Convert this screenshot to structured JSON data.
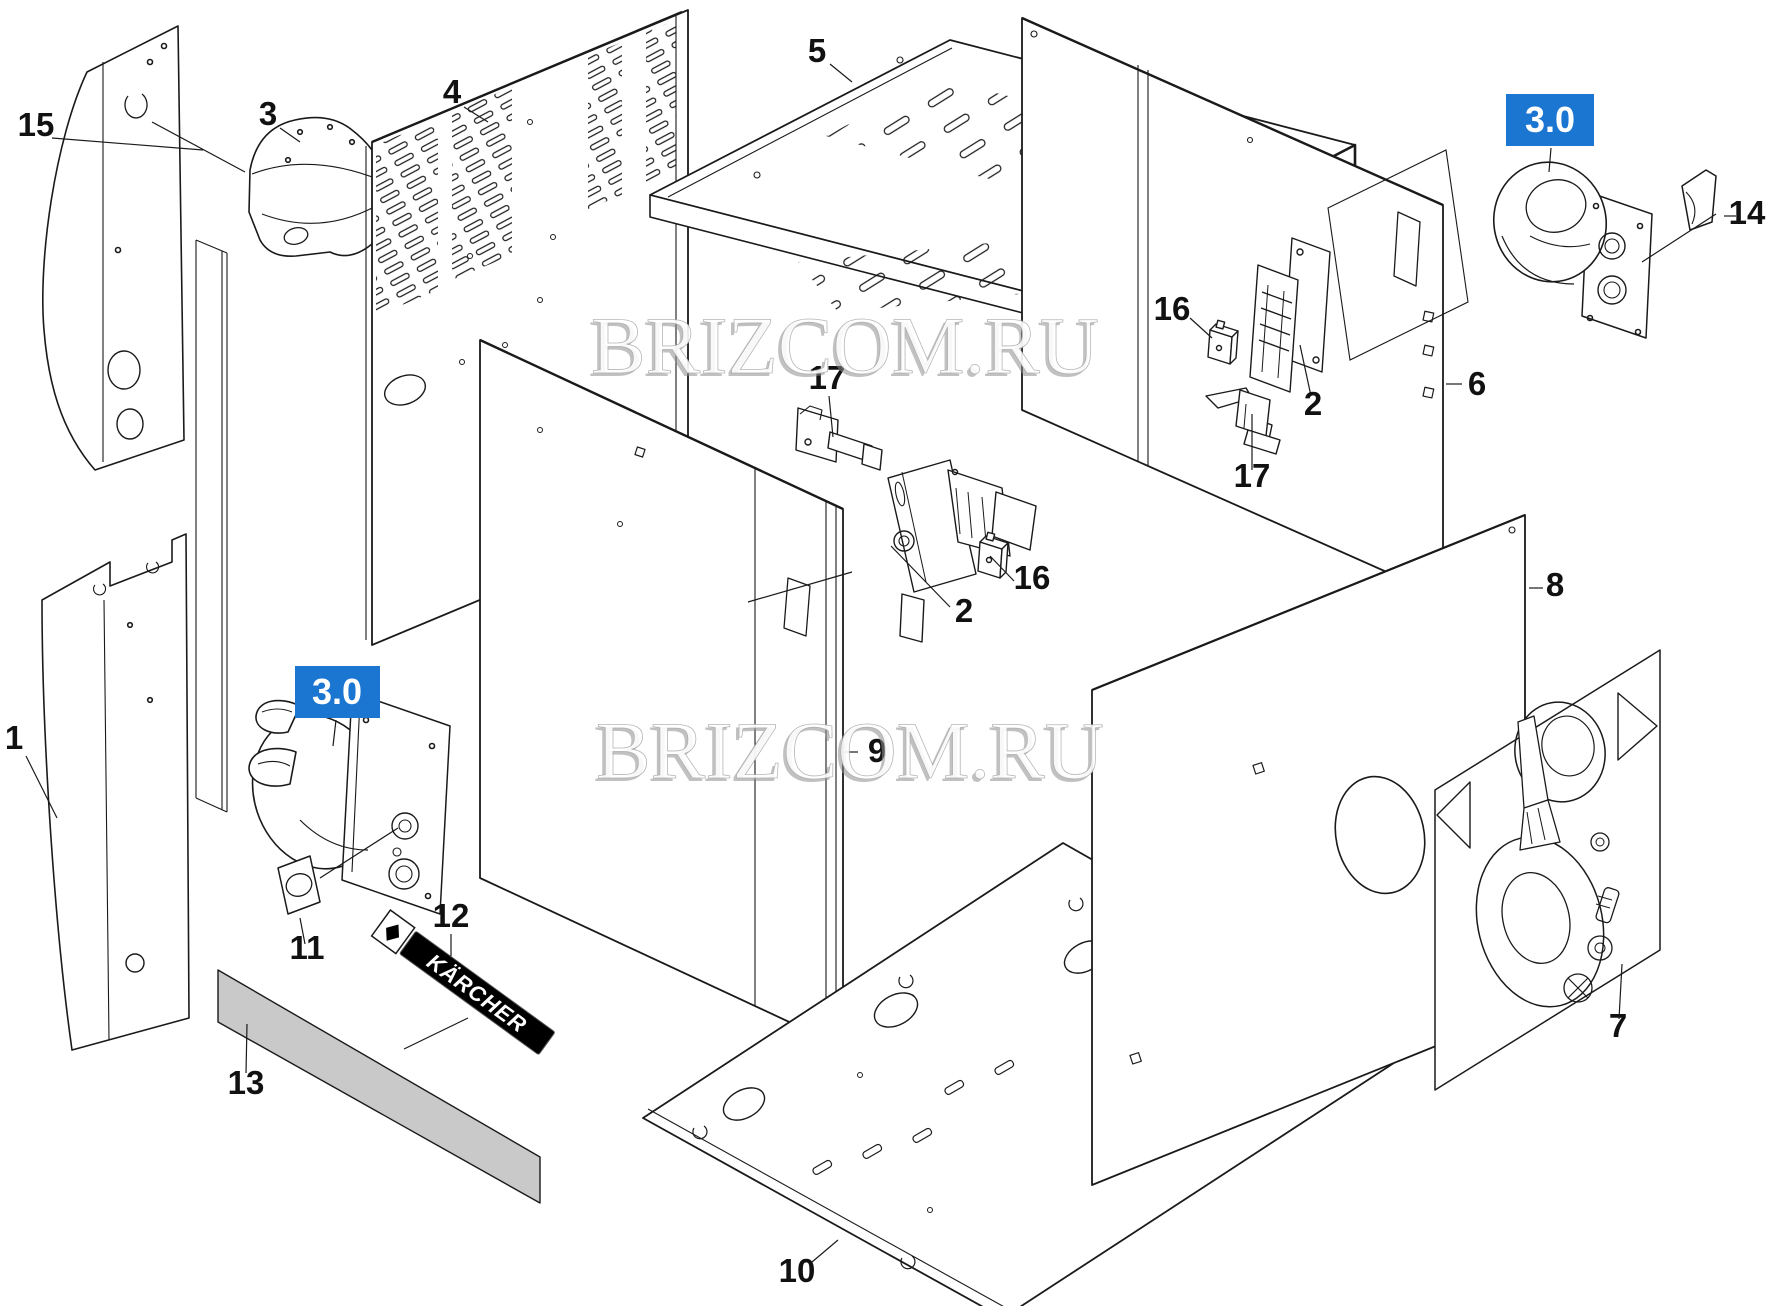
{
  "diagram": {
    "type": "exploded-parts-diagram",
    "watermark": {
      "text": "BRIZCOM.RU",
      "color": "#ffffff"
    },
    "badge": {
      "text": "3.0",
      "bg": "#1b76d2",
      "fg": "#ffffff"
    },
    "brand": {
      "text": "KÄRCHER",
      "bg": "#000000",
      "fg": "#ffffff"
    },
    "line_color": "#1a1a1a",
    "strip_fill": "#c9c9c9",
    "labels": [
      {
        "id": "label-15",
        "text": "15"
      },
      {
        "id": "label-3",
        "text": "3"
      },
      {
        "id": "label-4",
        "text": "4"
      },
      {
        "id": "label-5",
        "text": "5"
      },
      {
        "id": "label-17-center",
        "text": "17"
      },
      {
        "id": "label-2-center",
        "text": "2"
      },
      {
        "id": "label-16-center",
        "text": "16"
      },
      {
        "id": "label-16-right",
        "text": "16"
      },
      {
        "id": "label-2-right",
        "text": "2"
      },
      {
        "id": "label-17-right",
        "text": "17"
      },
      {
        "id": "label-6",
        "text": "6"
      },
      {
        "id": "label-14",
        "text": "14"
      },
      {
        "id": "label-9",
        "text": "9"
      },
      {
        "id": "label-8",
        "text": "8"
      },
      {
        "id": "label-1",
        "text": "1"
      },
      {
        "id": "label-11",
        "text": "11"
      },
      {
        "id": "label-12",
        "text": "12"
      },
      {
        "id": "label-13",
        "text": "13"
      },
      {
        "id": "label-7",
        "text": "7"
      },
      {
        "id": "label-10",
        "text": "10"
      }
    ]
  }
}
